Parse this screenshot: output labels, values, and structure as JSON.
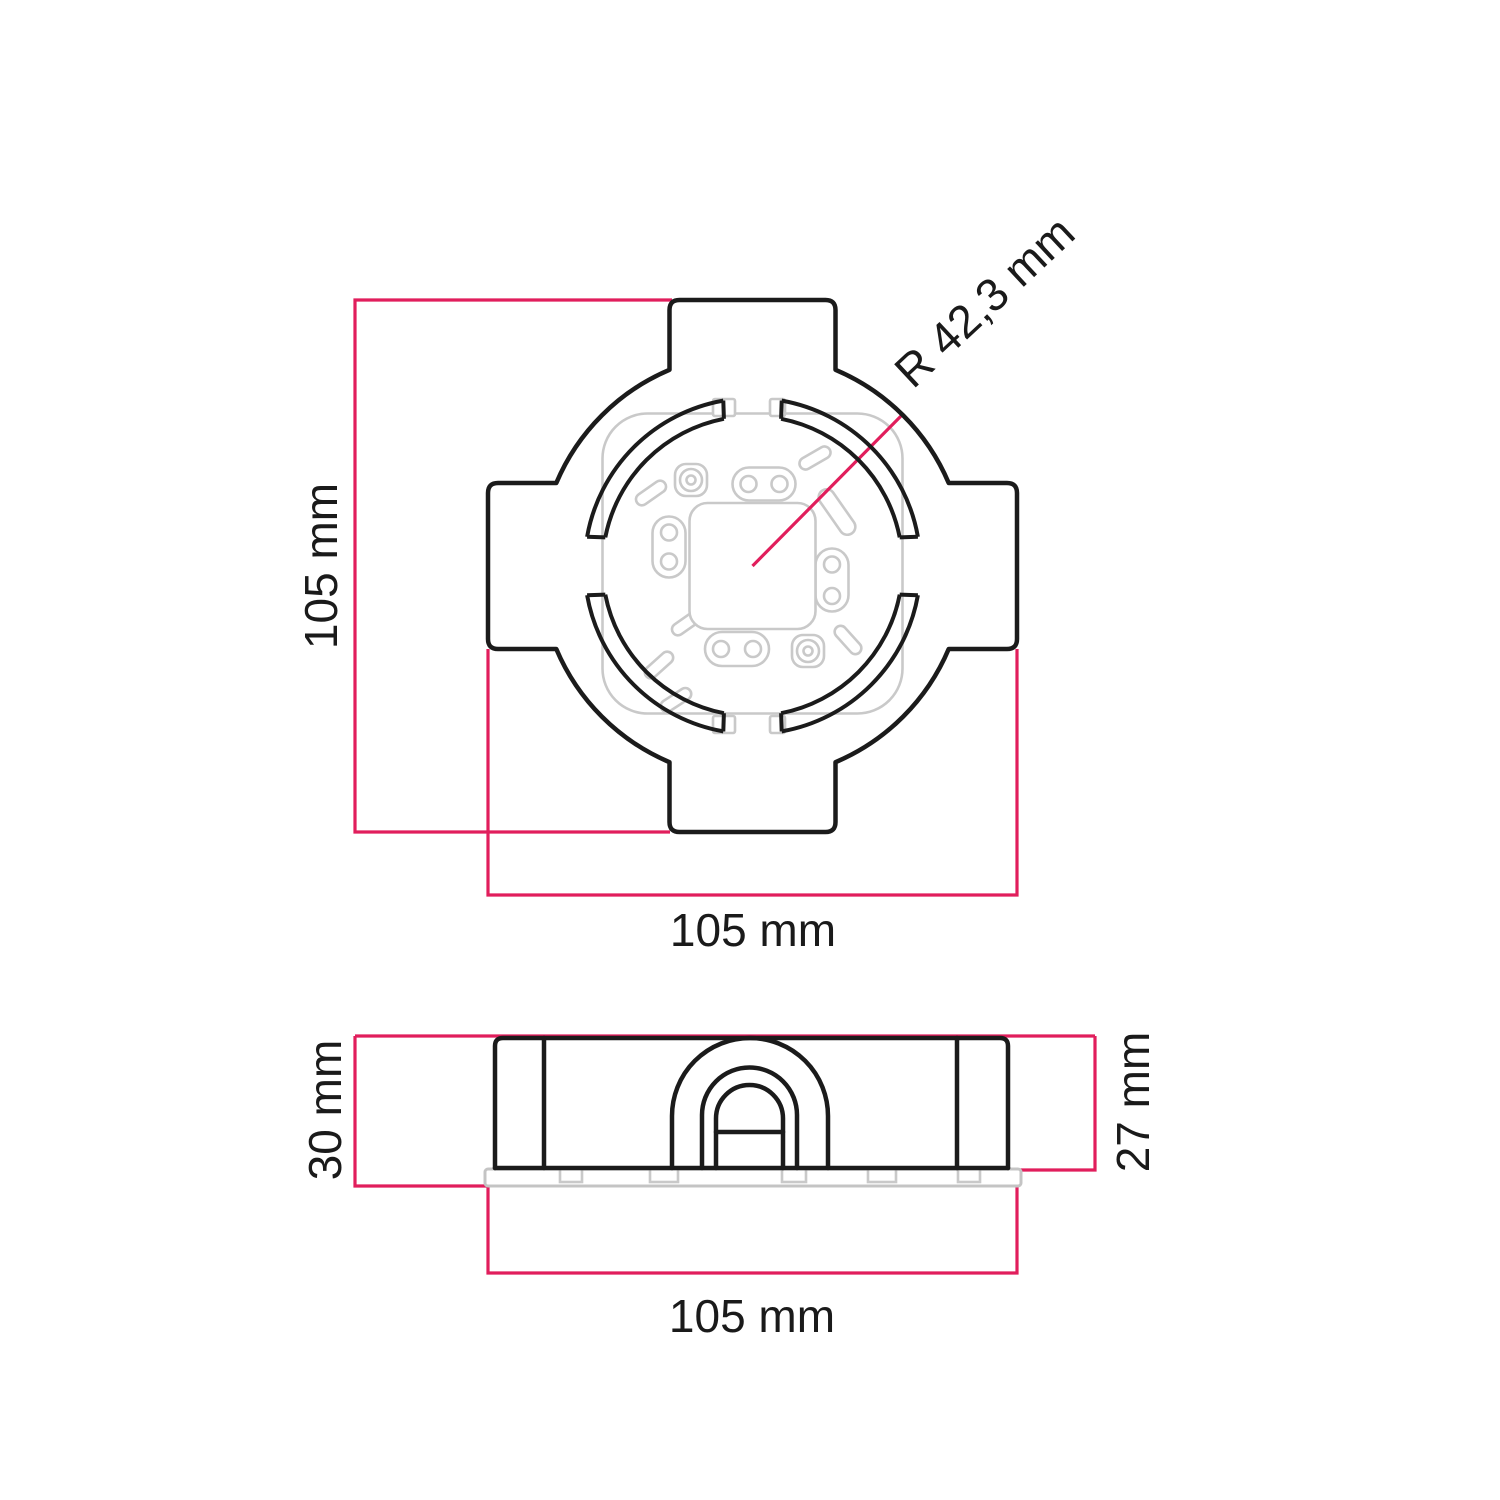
{
  "diagram": {
    "title": "junction-box-dimension-drawing",
    "top_view": {
      "height_label": "105 mm",
      "width_label": "105 mm",
      "radius_label": "R 42,3 mm"
    },
    "side_view": {
      "height_left_label": "30 mm",
      "height_right_label": "27 mm",
      "width_label": "105 mm"
    },
    "colors": {
      "dimension_line": "#e11e5c",
      "outline": "#1b1b1b",
      "internal_detail": "#c9c9c9",
      "background": "#ffffff"
    }
  }
}
